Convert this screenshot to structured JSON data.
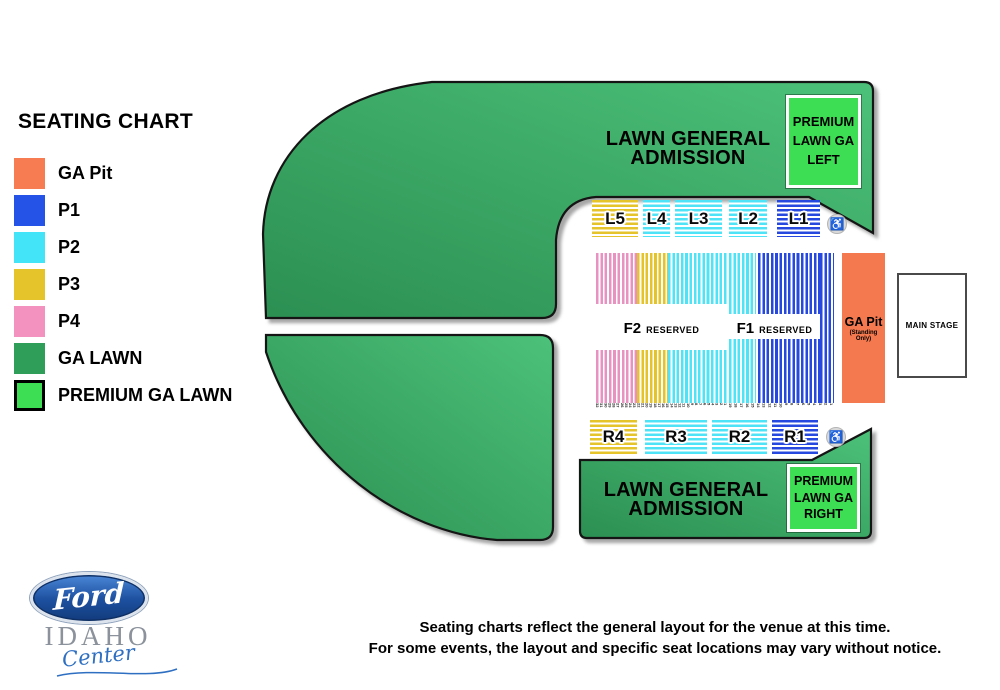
{
  "title": "SEATING CHART",
  "legend": [
    {
      "id": "ga-pit",
      "label": "GA Pit",
      "color": "#F87C52",
      "outlined": false
    },
    {
      "id": "p1",
      "label": "P1",
      "color": "#2553E8",
      "outlined": false
    },
    {
      "id": "p2",
      "label": "P2",
      "color": "#43E3F8",
      "outlined": false
    },
    {
      "id": "p3",
      "label": "P3",
      "color": "#E4C32B",
      "outlined": false
    },
    {
      "id": "p4",
      "label": "P4",
      "color": "#F392BF",
      "outlined": false
    },
    {
      "id": "ga-lawn",
      "label": "GA LAWN",
      "color": "#2F9E58",
      "outlined": false
    },
    {
      "id": "premium-ga-lawn",
      "label": "PREMIUM GA LAWN",
      "color": "#3EDE54",
      "outlined": true
    }
  ],
  "lawn": {
    "top_label": "LAWN GENERAL ADMISSION",
    "bottom_label": "LAWN GENERAL ADMISSION",
    "premium_left": "PREMIUM LAWN GA LEFT",
    "premium_right": "PREMIUM LAWN GA RIGHT",
    "gradient_dark": "#2B8F52",
    "gradient_light": "#4CC179"
  },
  "floor": {
    "l_row": [
      {
        "label": "L5",
        "color": "#E4C32B",
        "x": 592,
        "w": 46
      },
      {
        "label": "L4",
        "color": "#4FE3F7",
        "x": 643,
        "w": 27
      },
      {
        "label": "L3",
        "color": "#4FE3F7",
        "x": 675,
        "w": 47
      },
      {
        "label": "L2",
        "color": "#4FE3F7",
        "x": 729,
        "w": 38
      },
      {
        "label": "L1",
        "color": "#2748DF",
        "x": 777,
        "w": 43
      }
    ],
    "r_row": [
      {
        "label": "R4",
        "color": "#E4C32B",
        "x": 590,
        "w": 47
      },
      {
        "label": "R3",
        "color": "#4FE3F7",
        "x": 645,
        "w": 62
      },
      {
        "label": "R2",
        "color": "#4FE3F7",
        "x": 712,
        "w": 55
      },
      {
        "label": "R1",
        "color": "#2748DF",
        "x": 772,
        "w": 46
      }
    ],
    "f2": {
      "label": "F2",
      "sublabel": "RESERVED",
      "groups": [
        {
          "color": "#E892C2",
          "x": 596,
          "w": 41
        },
        {
          "color": "#E4C32B",
          "x": 637,
          "w": 31
        },
        {
          "color": "#4FE3F7",
          "x": 668,
          "w": 59
        }
      ]
    },
    "f1": {
      "label": "F1",
      "sublabel": "RESERVED",
      "groups": [
        {
          "color": "#4FE3F7",
          "x": 729,
          "w": 27
        },
        {
          "color": "#2748DF",
          "x": 758,
          "w": 62
        }
      ],
      "full_strip": {
        "color": "#2748DF",
        "x": 820,
        "w": 14
      }
    },
    "f2_ticks": [
      "32",
      "31",
      "30",
      "29",
      "28",
      "27",
      "26",
      "25",
      "24",
      "23",
      "22",
      "21",
      "20",
      "19",
      "18",
      "17",
      "16",
      "15",
      "14",
      "13",
      "12",
      "11",
      "10",
      "9",
      "8",
      "7",
      "6",
      "5",
      "4",
      "3",
      "2",
      "1"
    ],
    "f1_ticks": [
      "19",
      "18",
      "17",
      "16",
      "15",
      "14",
      "13",
      "12",
      "11",
      "10",
      "9",
      "8",
      "7",
      "6",
      "5",
      "4",
      "3",
      "2",
      "1"
    ],
    "ga_pit": {
      "label": "GA Pit",
      "sublabel": "(Standing Only)",
      "color": "#F4794E"
    },
    "stage_label": "MAIN STAGE"
  },
  "icons": {
    "wheelchair": "♿"
  },
  "footer": {
    "line1": "Seating charts reflect the general layout for the venue at this time.",
    "line2": "For some events, the layout and specific seat locations may vary without notice."
  },
  "logo": {
    "brand": "Ford",
    "venue": "IDAHO",
    "script": "Center"
  }
}
